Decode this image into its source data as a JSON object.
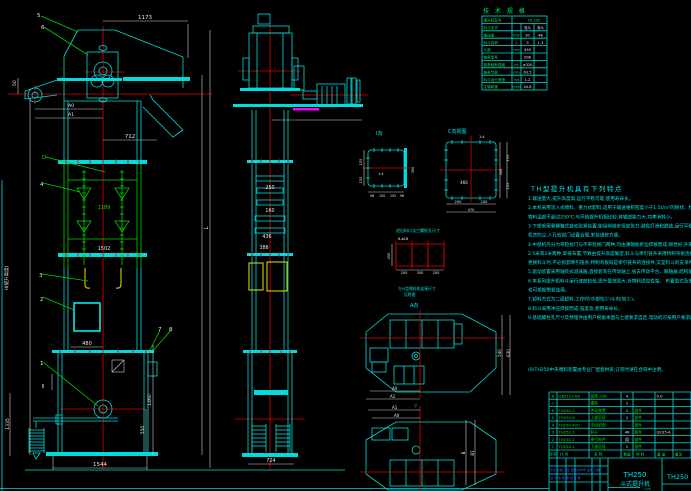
{
  "drawing": {
    "type": "CAD bucket elevator assembly drawing",
    "background": "#000000",
    "accent_colors": {
      "geometry": "#00dcdc",
      "midsection": "#00d400",
      "centerline": "#e00000",
      "dimension": "#e8e8e8",
      "highlight": "#ffff00",
      "selection": "#ff00ff",
      "titleblock_text": "#4a63ff"
    }
  },
  "front_view": {
    "balloons": {
      "b1": "1",
      "b2": "2",
      "b3": "3",
      "b4": "4",
      "b5": "5",
      "b6": "6",
      "b7": "7",
      "b8": "8"
    },
    "dims": {
      "d1173": "1173",
      "d712": "712",
      "a0": "A0",
      "a1": "A1",
      "d50": "50",
      "d1189": "1189",
      "d1502": "1502",
      "d480": "480",
      "d1335": "1335",
      "d1460": "1460",
      "d550": "550",
      "d1544": "1544",
      "h_label": "H(提升高度)",
      "l_label": "L",
      "section2": "Ⅱ",
      "d_label": "D"
    }
  },
  "side_view": {
    "dims": {
      "d250": "250",
      "d160": "160",
      "d436": "436",
      "d388": "388",
      "d724": "724"
    }
  },
  "detail_a": {
    "label": "Ⅰ向",
    "scale": "1:4",
    "l1": "155",
    "l2": "155",
    "r1": "300",
    "b1": "98",
    "b2": "155",
    "b3": "155",
    "b4": "98"
  },
  "detail_c": {
    "label": "C向视图",
    "scale": "1:4",
    "inner": "466",
    "b1": "200",
    "b2": "200",
    "b3": "470",
    "r1": "300",
    "r2": "155",
    "r3": "155"
  },
  "feed_detail": {
    "title": "进出料口法兰螺栓孔尺寸",
    "holes": "8-φ18",
    "left": "450",
    "b1": "200",
    "b2": "300",
    "b3": "200"
  },
  "coupling_note": {
    "line1": "与YJ型喂料机连接尺寸",
    "line2": "见附图",
    "view_label": "A向"
  },
  "plan_a": {
    "a0": "A0",
    "a1": "A1",
    "r1": "540",
    "r2": "630"
  },
  "plan_b": {
    "marker": "▽",
    "a0": "A0",
    "a1": "A1",
    "r1": "B",
    "r2": "B1"
  },
  "spec_table": {
    "title": "技 术 规 格",
    "rows": [
      {
        "label": "提升机型号",
        "unit": "",
        "v1": "TH 250",
        "v2": ""
      },
      {
        "label": "料斗形式",
        "unit": "",
        "v1": "浅斗",
        "v2": "深斗"
      },
      {
        "label": "输送量",
        "unit": "m³/h",
        "v1": "30",
        "v2": "48"
      },
      {
        "label": "料斗容积",
        "unit": "L",
        "v1": "3",
        "v2": "1.3"
      },
      {
        "label": "斗距",
        "unit": "mm",
        "v1": "450",
        "v2": ""
      },
      {
        "label": "链条型号",
        "unit": "",
        "v1": "20B",
        "v2": ""
      },
      {
        "label": "链条破断强度",
        "unit": "kN",
        "v1": "≥320",
        "v2": ""
      },
      {
        "label": "链条节距",
        "unit": "mm",
        "v1": "63.5",
        "v2": ""
      },
      {
        "label": "料斗运行速度",
        "unit": "m/s",
        "v1": "1.2",
        "v2": ""
      },
      {
        "label": "主轴转速",
        "unit": "r/min",
        "v1": "44.8",
        "v2": ""
      }
    ]
  },
  "notes": {
    "title": "TH型提升机具有下列特点",
    "lines": [
      "1.输送量大,提升高度高,运行平稳可靠,使用寿命长。",
      "2.本机采用流入式喂料、重力式卸料,适用于输送堆积密度小于1.5t/m³的粉状、粒状、小块状的无磨琢性、半磨琢性物料",
      "  物料温度不超过250℃,与环链提升机相比较,其输送能力大,功率消耗小。",
      "3.下部采用重锤箱式自动张紧装置,能保持链条恒定张力,避免打滑和脱链,运行平稳可靠,大大延长使用寿命,",
      "  机壳防尘,人孔检视门设置合理,安装维修方便。",
      "4.中部机壳分为带检视门与不带检视门两种,均由薄钢板折边焊接而成,刚性好,外形美观,中部机壳每节高度有",
      "  2.5米和2米两种,单排布置,节数由提升高度确定,料斗与牵引链条采用特制弯板连接,结构简单,装拆方便,",
      "  更换料斗时,不必拆卸牵引链条,特制弯板既是牵引链条的连接件,又是料斗的支承件。",
      "5.驱动装置采用轴装式减速器,直接套装在传动轴上,省去传动平台、联轴器,结构紧凑,重量轻,安装维修方便。",
      "6.本系列提升机料斗运行速度较低,提升量范围大,对物料适应性强。          布置型式及安装尺寸详见样本,用户",
      "  也可根据需要选用。",
      "7.卸料方式为二级卸料,工作时(中部较少)斗内(较少)。",
      "8.料斗采用冲压焊接而成,强度高,使用寿命长。",
      "9.基础螺栓孔尺寸及预埋件由用户根据本图与土建要求自定,电动机可按用户要求配置(驱动功率见选用表)。"
    ],
    "extra": "(9)TH250中央喂料装置由专业厂配套供货,订货时请在合同中注明。"
  },
  "parts_list": {
    "headers": [
      "序号",
      "代  号",
      "名  称",
      "数量",
      "材 料",
      "重 量",
      "备注"
    ],
    "rows": [
      [
        "8",
        "GB5127-84",
        "链条 20B",
        "4",
        "",
        "9.0",
        ""
      ],
      [
        "7",
        "",
        "螺栓",
        "1",
        "",
        "",
        ""
      ],
      [
        "6",
        "TH250.7",
        "传动装置",
        "1",
        "部件",
        "",
        ""
      ],
      [
        "5",
        "TH250.6",
        "上部区段",
        "1",
        "部件",
        "",
        ""
      ],
      [
        "4",
        "TH250.4(5)",
        "中间机壳",
        "",
        "部件",
        "",
        ""
      ],
      [
        "3",
        "TH250.3",
        "料斗",
        "46",
        "组件",
        "Q235-A",
        ""
      ],
      [
        "2",
        "TH250.2",
        "牵引构件",
        "组",
        "部件",
        "",
        ""
      ],
      [
        "1",
        "TH250.1",
        "下部区段",
        "1",
        "部件",
        "",
        ""
      ]
    ]
  },
  "title_block": {
    "model": "TH250",
    "name": "斗式提升机",
    "drawing_no": "TH250",
    "rev_row": "标记 处数 分区 更改文件号 签名 日期",
    "sign_row": "设 计  校 核  审 定  批 准",
    "scale": "1:25"
  }
}
